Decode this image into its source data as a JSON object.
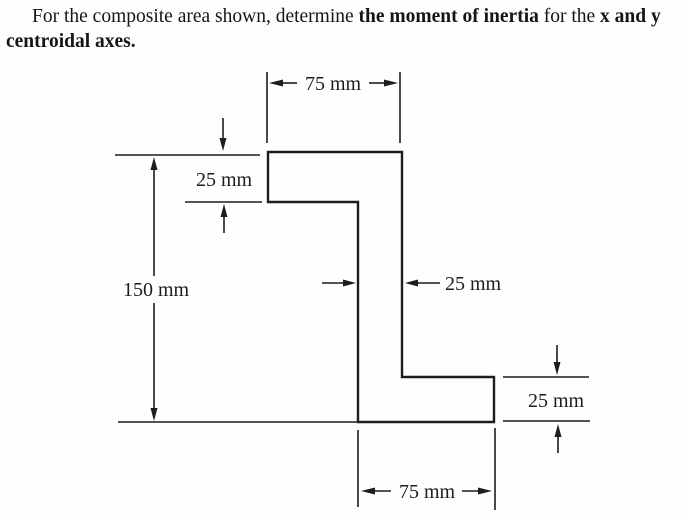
{
  "problem": {
    "text_1": "For the composite area shown, determine ",
    "bold_1": "the moment of inertia",
    "text_2": " for the ",
    "bold_2": "x and y",
    "bold_3": "centroidal axes."
  },
  "figure": {
    "type": "z-section-composite-area-drawing",
    "ink_color": "#1d1d1d",
    "background_color": "#ffffff",
    "dimensions": {
      "top_width": "75 mm",
      "top_flange_thickness": "25 mm",
      "overall_height": "150 mm",
      "web_thickness": "25 mm",
      "bottom_flange_thickness": "25 mm",
      "bottom_width": "75 mm"
    }
  }
}
